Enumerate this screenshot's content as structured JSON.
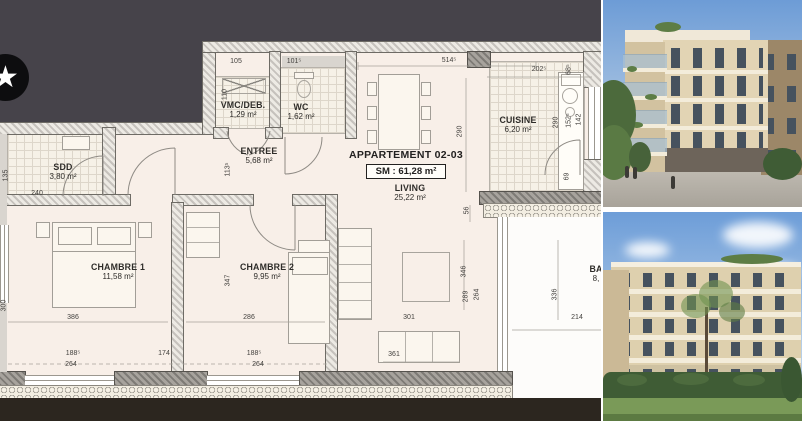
{
  "plan": {
    "title": "APPARTEMENT 02-03",
    "surface": "SM : 61,28 m²",
    "logo_glyph": "★",
    "rooms": {
      "sdd": {
        "name": "SDD",
        "area": "3,80 m²"
      },
      "vmc": {
        "name": "VMC/DEB.",
        "area": "1,29 m²"
      },
      "wc": {
        "name": "WC",
        "area": "1,62 m²"
      },
      "entree": {
        "name": "ENTREE",
        "area": "5,68 m²"
      },
      "cuisine": {
        "name": "CUISINE",
        "area": "6,20 m²"
      },
      "living": {
        "name": "LIVING",
        "area": "25,22 m²"
      },
      "chambre1": {
        "name": "CHAMBRE 1",
        "area": "11,58 m²"
      },
      "chambre2": {
        "name": "CHAMBRE 2",
        "area": "9,95 m²"
      },
      "balcon": {
        "name": "BA",
        "area": "8,"
      }
    },
    "dims": {
      "d105": "105",
      "d101": "101⁵",
      "d514": "514⁵",
      "d202": "202⁵",
      "d68": "68⁵",
      "d110": "110",
      "d113": "113⁵",
      "d135": "135",
      "d240": "240",
      "d290a": "290",
      "d290b": "290",
      "d152": "152⁵",
      "d142": "142",
      "d69": "69",
      "d56": "56",
      "d346": "346",
      "d289": "289",
      "d264a": "264",
      "d301": "301",
      "d361": "361",
      "d336": "336",
      "d214": "214",
      "d300": "300",
      "d386": "386",
      "d188a": "188⁵",
      "d264b": "264",
      "d174": "174",
      "d347": "347",
      "d286": "286",
      "d188b": "188⁵",
      "d264c": "264"
    },
    "colors": {
      "wall_dark": "#46434a",
      "plan_bg": "#f8efe8",
      "ground": "#2c261f"
    }
  },
  "photos": {
    "top": "building-render-street-view",
    "bottom": "building-render-garden-view"
  }
}
